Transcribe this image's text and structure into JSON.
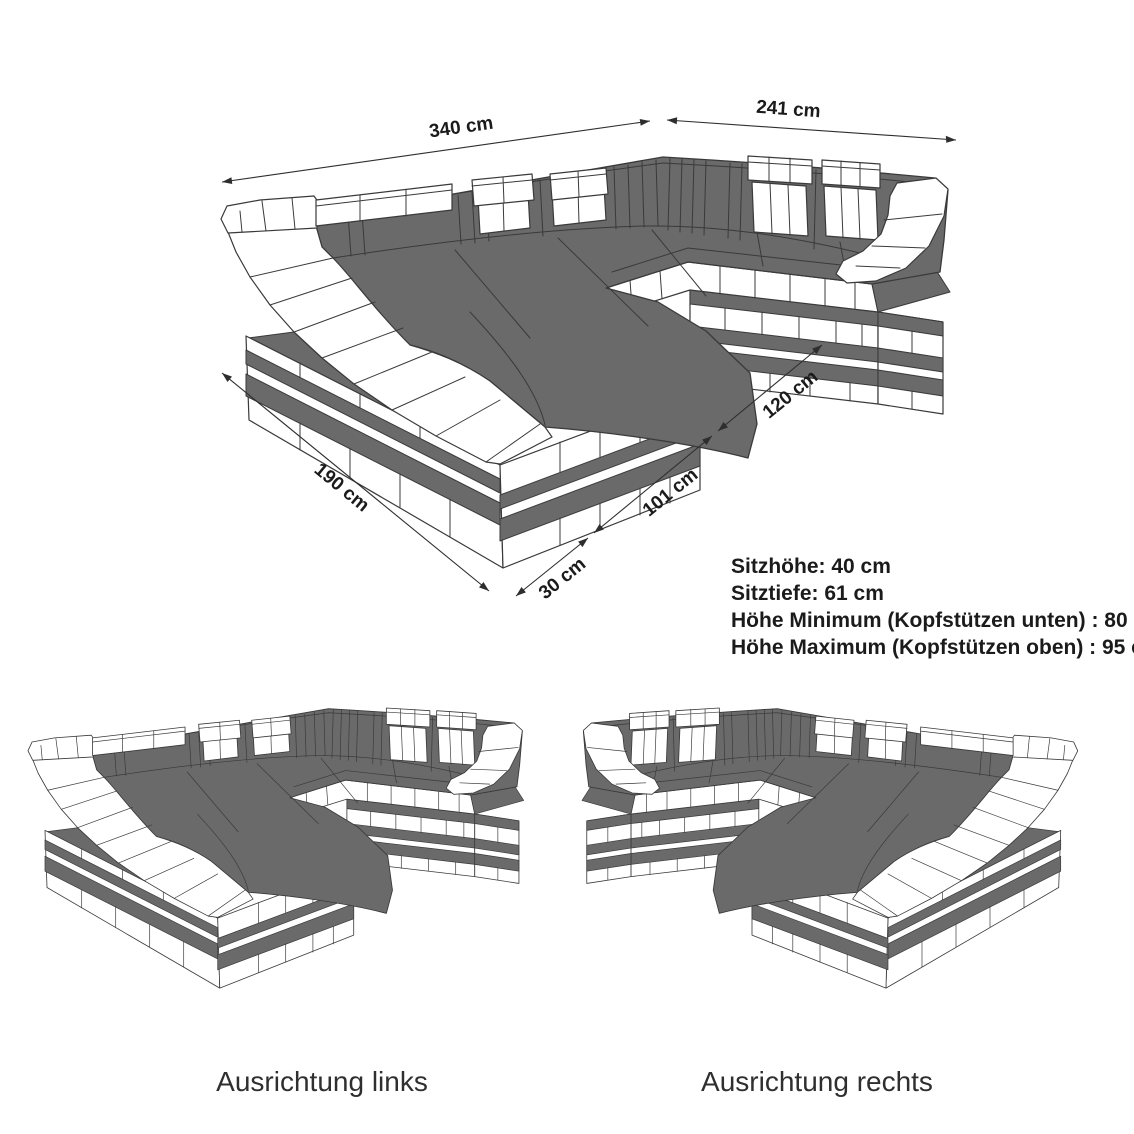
{
  "diagram": {
    "dimensions": {
      "back_width": "340 cm",
      "right_width": "241 cm",
      "chaise_length": "190 cm",
      "front_depth": "120 cm",
      "chaise_width": "101 cm",
      "base_ledge": "30 cm"
    },
    "specs": [
      "Sitzhöhe: 40 cm",
      "Sitztiefe: 61 cm",
      "Höhe Minimum (Kopfstützen unten) : 80 cm",
      "Höhe Maximum (Kopfstützen oben) : 95 cm"
    ],
    "variants": [
      {
        "label": "Ausrichtung links"
      },
      {
        "label": "Ausrichtung rechts"
      }
    ],
    "colors": {
      "upholstery_dark": "#6a6a6a",
      "frame_light": "#ffffff",
      "outline": "#3a3a3a"
    }
  }
}
